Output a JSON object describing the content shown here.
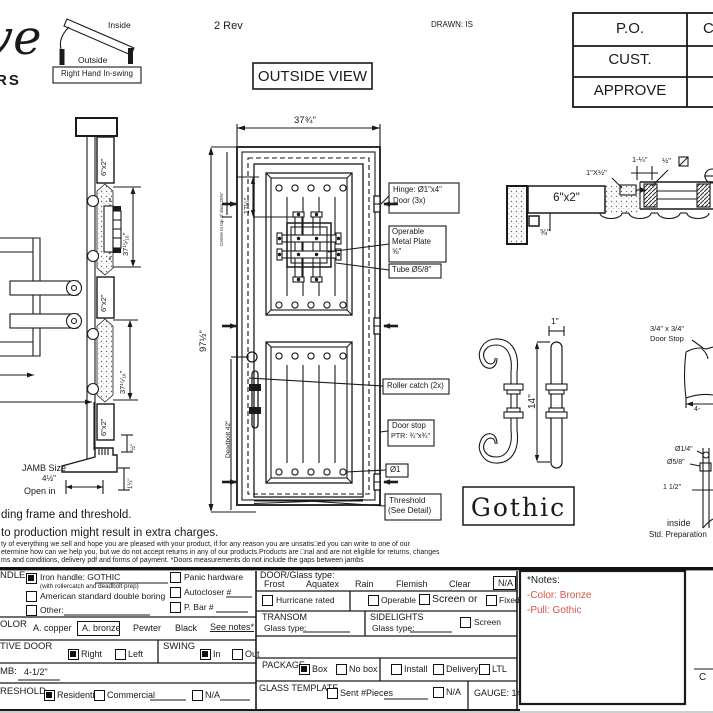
{
  "colors": {
    "ink": "#1a1a1a",
    "red": "#d9534f"
  },
  "header": {
    "logo_script": "ve",
    "logo_sub": "RS",
    "rev": "2 Rev",
    "drawn": "DRAWN: IS",
    "view": "OUTSIDE VIEW",
    "swing_inside": "Inside",
    "swing_outside": "Outside",
    "swing_tag": "Right Hand In-swing",
    "po": "P.O.",
    "cust": "CUST.",
    "approve": "APPROVE",
    "po_value": "C"
  },
  "dims": {
    "door_width": "37¾\"",
    "door_height": "97½\"",
    "centre_note": "Centre to top of door 25⅜\"",
    "grille": "17¼\"",
    "deadbolt": "Deadbolt 42\"",
    "jamb_block": "6\"x2\"",
    "jamb_span": "37¹⁵⁄₁₆\"",
    "half": "½\"",
    "one_quarter": "1¼\"",
    "jamb_size_label": "JAMB Size",
    "jamb_size_value": "4½\"",
    "open_in": "Open in"
  },
  "callouts": {
    "hinge1": "Hinge: Ø1\"x4\"",
    "hinge2": "Door (3x)",
    "plate1": "Operable",
    "plate2": "Metal Plate",
    "plate3": "⅝\"",
    "tube": "Tube Ø5/8\"",
    "roller": "Roller catch (2x)",
    "stop1": "Door stop",
    "stop2": "PTR: ¾\"x¾\"",
    "dia": "Ø1",
    "thresh1": "Threshold",
    "thresh2": "(See Detail)"
  },
  "head_detail": {
    "block": "6\"x2\"",
    "three_eighths": "⅜\"",
    "one_x_half": "1\"X½\"",
    "one_quarter": "1-¼\"",
    "half": "½\""
  },
  "handle": {
    "width": "1\"",
    "length": "14''",
    "name": "Gothic"
  },
  "right_details": {
    "stop1": "3/4\" x 3/4\"",
    "stop2": "Door Stop",
    "four": "4-",
    "d1": "Ø1/4\"",
    "d2": "Ø5/8\"",
    "d3": "1 1/2\"",
    "inside": "inside",
    "std": "Std. Preparation"
  },
  "paragraphs": {
    "p1": "ding frame and threshold.",
    "p2": "to production might result in extra charges.",
    "s1": "ty of everything we sell and hope you are pleased with your product, if for any reason you are unsatis□ed you can write to one of our",
    "s2": "etermine how can we help you, but we do not accept returns in any of our products.Products are □nal and are not eligible for returns, changes",
    "s3": "ms and conditions, delivery pdf and forms of payment. *Doors measurements do not include the gaps between jambs"
  },
  "form": {
    "handle_label": "NDLE",
    "iron": "Iron handle: GOTHIC",
    "iron_sub": "(with rollercatch and deadbolt prep)",
    "american": "American standard double boring",
    "other": "Other:",
    "panic": "Panic hardware",
    "autocloser": "Autocloser #",
    "pbar": "P. Bar #",
    "color_label": "OLOR",
    "copper": "A. copper",
    "bronze": "A. bronze",
    "pewter": "Pewter",
    "black": "Black",
    "see_notes": "See notes*",
    "active_label": "TIVE DOOR",
    "right": "Right",
    "left": "Left",
    "swing_label": "SWING",
    "in": "In",
    "out": "Out",
    "jamb_label": "MB:",
    "jamb_value": "4-1/2\"",
    "threshold_label": "RESHOLD",
    "residential": "Residential",
    "commercial": "Commercial",
    "na": "N/A",
    "glass_label": "DOOR/Glass type:",
    "frost": "Frost",
    "aquatex": "Aquatex",
    "rain": "Rain",
    "flemish": "Flemish",
    "clear": "Clear",
    "glass_na": "N/A",
    "hurricane": "Hurricane rated",
    "operable": "Operable",
    "screen_or": "Screen or",
    "fixed": "Fixed",
    "transom": "TRANSOM",
    "glass_type": "Glass type:",
    "sidelights": "SIDELIGHTS",
    "screen": "Screen",
    "package": "PACKAGE",
    "box": "Box",
    "no_box": "No box",
    "install": "Install",
    "delivery": "Delivery",
    "ltl": "LTL",
    "template": "GLASS TEMPLATE",
    "sent": "Sent #Pieces",
    "template_na": "N/A",
    "gauge": "GAUGE: 14",
    "notes_title": "*Notes:",
    "note_color": "-Color: Bronze",
    "note_pull": "-Pull: Gothic",
    "corner": "C"
  }
}
